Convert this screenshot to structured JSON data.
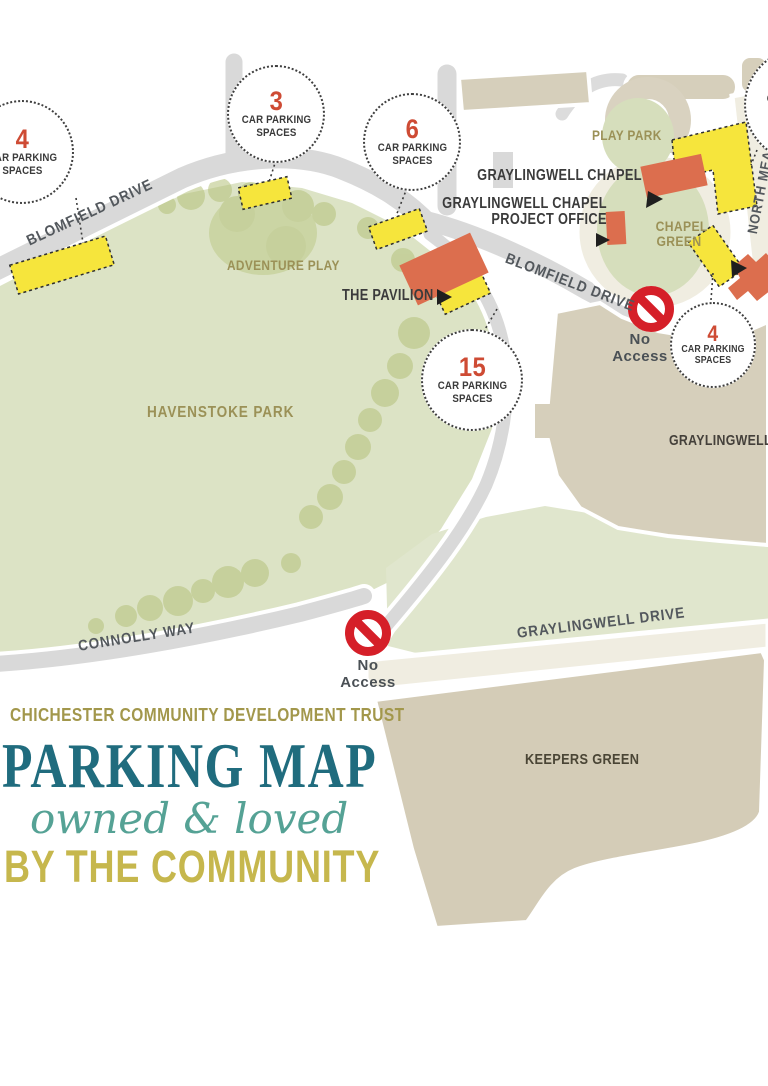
{
  "header": {
    "org": "CHICHESTER COMMUNITY DEVELOPMENT TRUST",
    "title": "PARKING MAP",
    "tagline": "owned & loved",
    "subtitle": "BY THE COMMUNITY"
  },
  "map": {
    "roads": {
      "blomfield": "BLOMFIELD DRIVE",
      "connolly": "CONNOLLY WAY",
      "graylingwell_drive": "GRAYLINGWELL DRIVE",
      "north_mead": "NORTH MEAD"
    },
    "areas": {
      "havenstoke": "HAVENSTOKE PARK",
      "adventure_play": "ADVENTURE PLAY",
      "play_park": "PLAY PARK",
      "chapel_green_line1": "CHAPEL",
      "chapel_green_line2": "GREEN",
      "keepers_green": "KEEPERS GREEN",
      "graylingwell_park": "GRAYLINGWELL PARK"
    },
    "places": {
      "chapel": "GRAYLINGWELL CHAPEL",
      "project_office_line1": "GRAYLINGWELL CHAPEL",
      "project_office_line2": "PROJECT OFFICE",
      "pavilion": "THE PAVILION"
    },
    "no_access": {
      "line1": "No",
      "line2": "Access"
    },
    "badges": [
      {
        "number": "4",
        "line1": "CAR PARKING",
        "line2": "SPACES"
      },
      {
        "number": "3",
        "line1": "CAR PARKING",
        "line2": "SPACES"
      },
      {
        "number": "6",
        "line1": "CAR PARKING",
        "line2": "SPACES"
      },
      {
        "number": "15",
        "line1": "CAR PARKING",
        "line2": "SPACES"
      },
      {
        "number": "4",
        "line1": "CAR PARKING",
        "line2": "SPACES"
      },
      {
        "number": "",
        "line1": "CAR PARKING",
        "line2": "SPACES"
      }
    ]
  },
  "colors": {
    "park_green": "#dce3c5",
    "small_green": "#d6debc",
    "tree_green": "#b5c27b",
    "road_gray": "#d9d9d9",
    "road_cream": "#f0ede1",
    "tan": "#d6cfbb",
    "building_orange": "#dc6e4e",
    "parking_yellow": "#f6e53c",
    "no_access_red": "#d51f28",
    "badge_number_red": "#ce4b34",
    "title_teal": "#206c7e",
    "title_gold": "#c6b74d",
    "title_olive": "#a2974b",
    "script_teal": "#55a295"
  }
}
